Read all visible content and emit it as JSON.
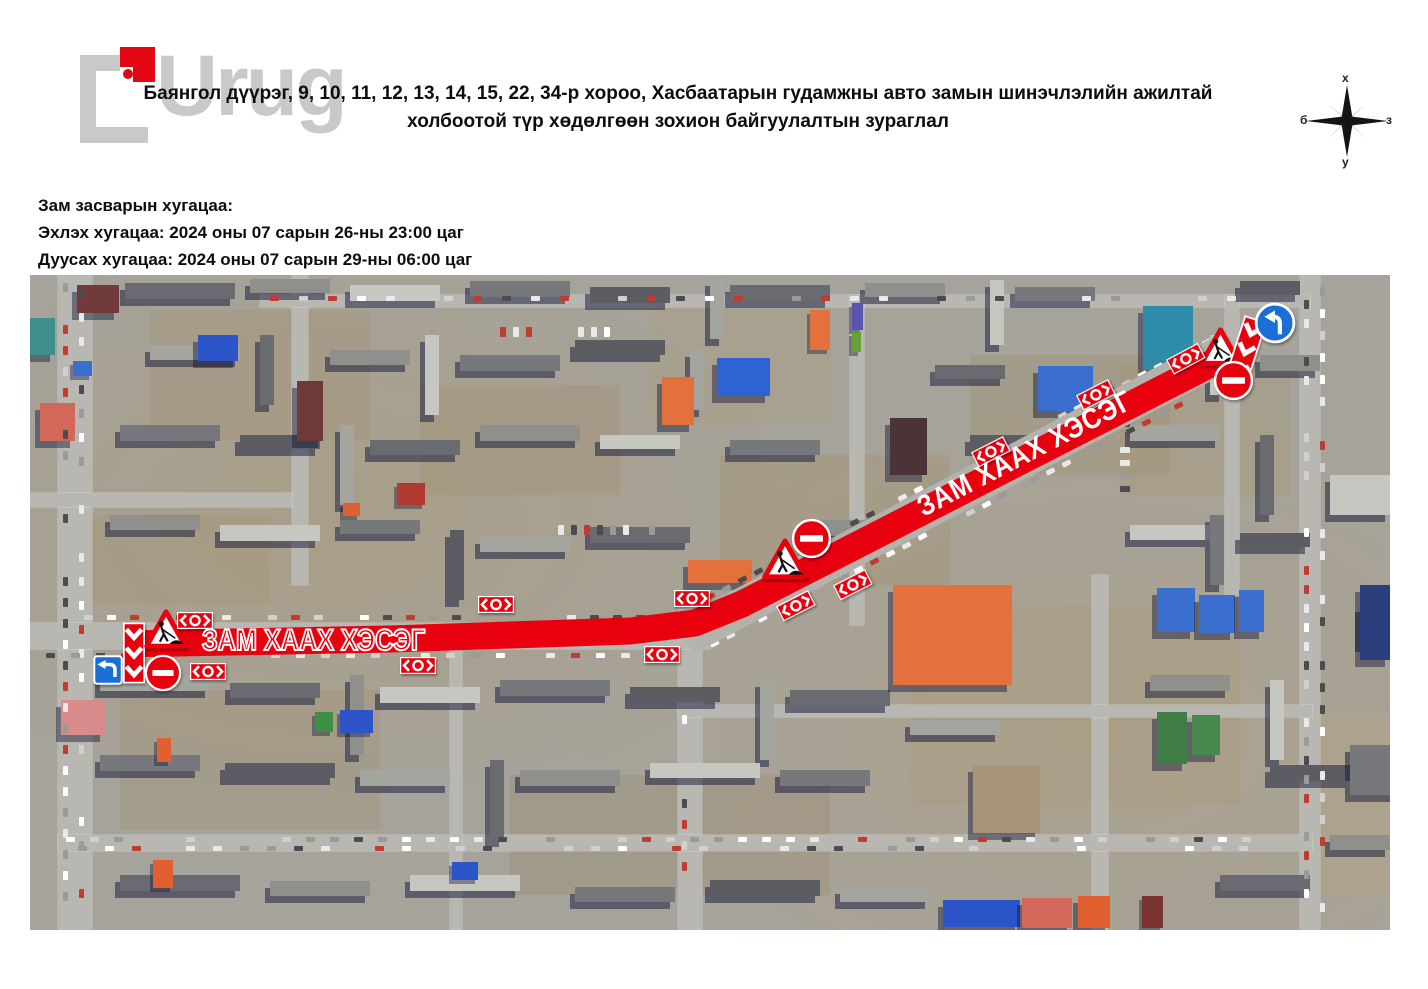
{
  "watermark": {
    "text": "Urug"
  },
  "header": {
    "title_line1": "Баянгол дүүрэг, 9, 10, 11, 12, 13, 14, 15, 22, 34-р хороо, Хасбаатарын гудамжны авто замын шинэчлэлийн ажилтай",
    "title_line2": "холбоотой түр хөдөлгөөн зохион байгуулалтын зураглал"
  },
  "schedule": {
    "heading": "Зам засварын хугацаа:",
    "start_line": "Эхлэх хугацаа: 2024 оны 07 сарын 26-ны 23:00 цаг",
    "end_line": "Дуусах хугацаа: 2024 оны 07 сарын 29-ны 06:00 цаг"
  },
  "compass": {
    "north_label": "х",
    "south_label": "у",
    "west_label": "б",
    "east_label": "з"
  },
  "map": {
    "closure_label_main": "ЗАМ ХААХ ХЭСЭГ",
    "closure_label_diagonal": "ЗАМ ХААХ ХЭСЭГ",
    "sign_types": [
      "roadworks-warning-sign",
      "no-entry-sign",
      "chevron-barrier-panel",
      "barrier-board-sign",
      "detour-left-sign",
      "keep-left-sign"
    ],
    "colors": {
      "closure_red": "#e8000f",
      "sign_blue": "#1b6ed6"
    }
  }
}
